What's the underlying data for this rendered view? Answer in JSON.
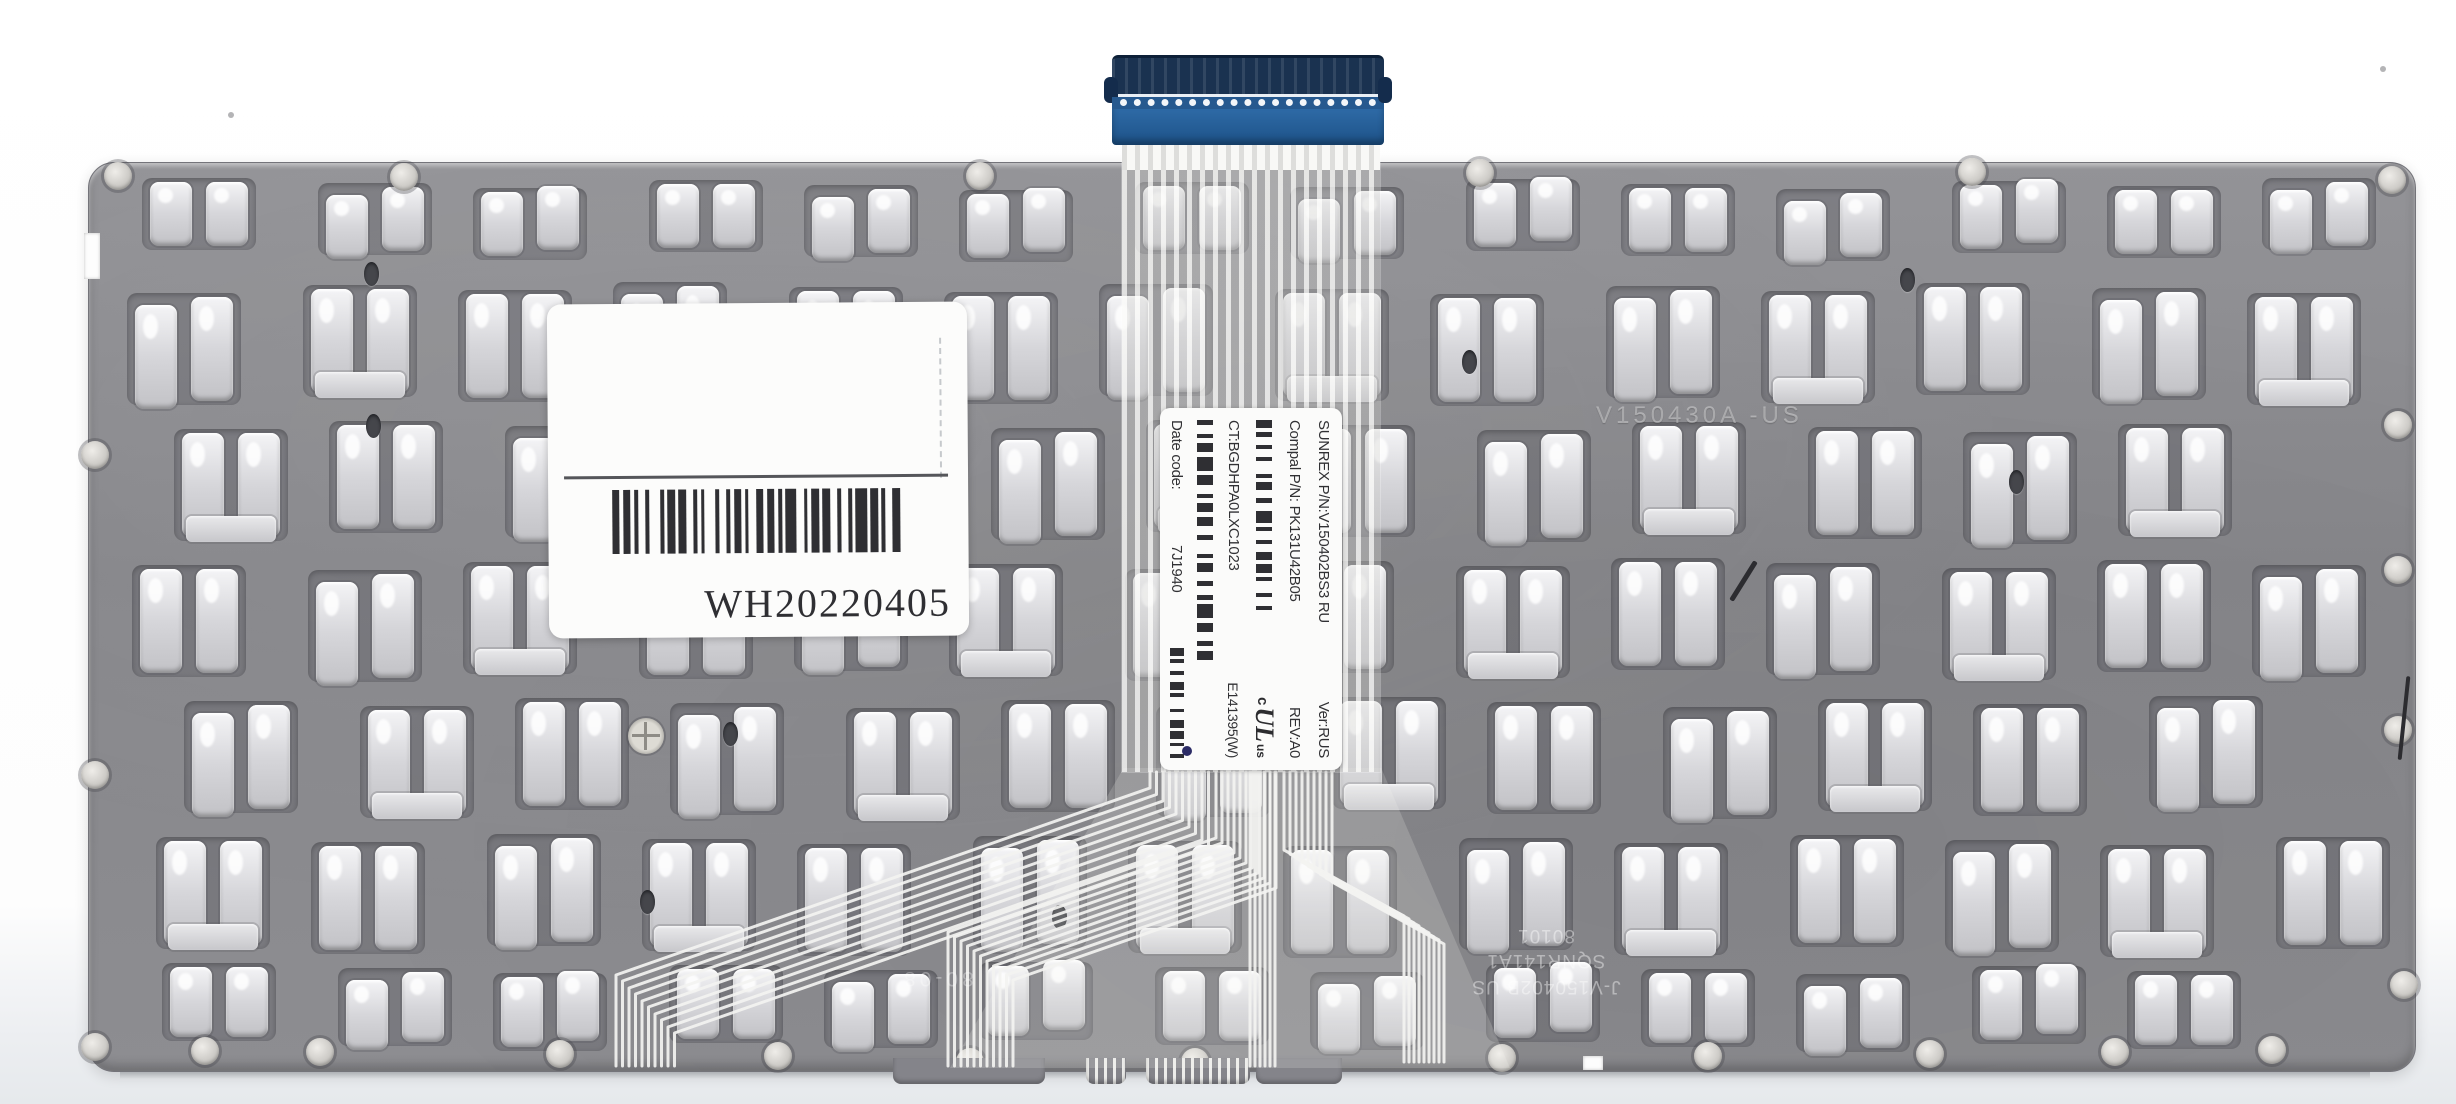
{
  "plate": {
    "color": "#8b8b8f",
    "marking": "V150430A -US",
    "grid_rows": [
      {
        "y": 182,
        "h": 76,
        "x0": 150,
        "pitch": 163,
        "n": 14,
        "small": true
      },
      {
        "y": 286,
        "h": 116,
        "x0": 128,
        "pitch": 163,
        "n": 14,
        "small": false
      },
      {
        "y": 424,
        "h": 116,
        "x0": 168,
        "pitch": 163,
        "n": 13,
        "small": false
      },
      {
        "y": 562,
        "h": 116,
        "x0": 140,
        "pitch": 163,
        "n": 14,
        "small": false
      },
      {
        "y": 700,
        "h": 116,
        "x0": 185,
        "pitch": 163,
        "n": 13,
        "small": false
      },
      {
        "y": 838,
        "h": 116,
        "x0": 150,
        "pitch": 163,
        "n": 14,
        "small": false
      },
      {
        "y": 966,
        "h": 82,
        "x0": 170,
        "pitch": 163,
        "n": 13,
        "small": true
      }
    ],
    "mount_width": 118,
    "screw_holes": [
      [
        118,
        176
      ],
      [
        404,
        177
      ],
      [
        980,
        176
      ],
      [
        1480,
        173
      ],
      [
        1972,
        172
      ],
      [
        2392,
        180
      ],
      [
        95,
        455
      ],
      [
        95,
        775
      ],
      [
        2398,
        425
      ],
      [
        2398,
        570
      ],
      [
        2398,
        730
      ],
      [
        2404,
        985
      ],
      [
        95,
        1047
      ],
      [
        205,
        1051
      ],
      [
        320,
        1052
      ],
      [
        560,
        1054
      ],
      [
        778,
        1056
      ],
      [
        970,
        1062
      ],
      [
        1195,
        1062
      ],
      [
        1502,
        1058
      ],
      [
        1708,
        1056
      ],
      [
        1930,
        1054
      ],
      [
        2115,
        1052
      ],
      [
        2272,
        1050
      ]
    ],
    "dark_holes": [
      [
        364,
        262
      ],
      [
        366,
        414
      ],
      [
        723,
        722
      ],
      [
        921,
        470
      ],
      [
        1462,
        350
      ],
      [
        2009,
        470
      ],
      [
        640,
        890
      ],
      [
        1900,
        268
      ],
      [
        1052,
        905
      ]
    ],
    "notches": [
      [
        84,
        233,
        16,
        46
      ],
      [
        1583,
        1056,
        20,
        14
      ]
    ],
    "bottom_tabs": [
      [
        893,
        152,
        false
      ],
      [
        1086,
        40,
        true
      ],
      [
        1146,
        104,
        true
      ],
      [
        1256,
        86,
        false
      ]
    ],
    "scratches": [
      [
        1741,
        558,
        5,
        46,
        32
      ],
      [
        2402,
        676,
        4,
        84,
        6
      ]
    ],
    "specks": [
      [
        228,
        112
      ],
      [
        2380,
        66
      ]
    ]
  },
  "warranty_label": {
    "code": "WH20220405",
    "barcode": "2121121311212211131211211221211132112122121131211221"
  },
  "ribbon_label": {
    "sunrex_pn": "SUNREX P/N:V150402BS3 RU",
    "ver": "Ver:RUS",
    "compal_pn": "Compal P/N: PK131U42B05",
    "rev": "REV:A0",
    "ct": "CT:BGDHPA0LXC1023",
    "date_code_label": "Date code:",
    "date_code": "7J1940",
    "ul_c": "c",
    "ul_core": "UL",
    "ul_us": "us",
    "ul_number": "E141395(W)",
    "barcode1": "21121213112212311212212113121",
    "barcode2": "121121312211212213112212113122112",
    "barcode3": "2112122113122121121"
  },
  "stamps": {
    "bottom_line1": "80101",
    "bottom_line2": "SQNR141A1",
    "bottom_line3": "J-V150402B US",
    "center_mark": "80-08"
  }
}
